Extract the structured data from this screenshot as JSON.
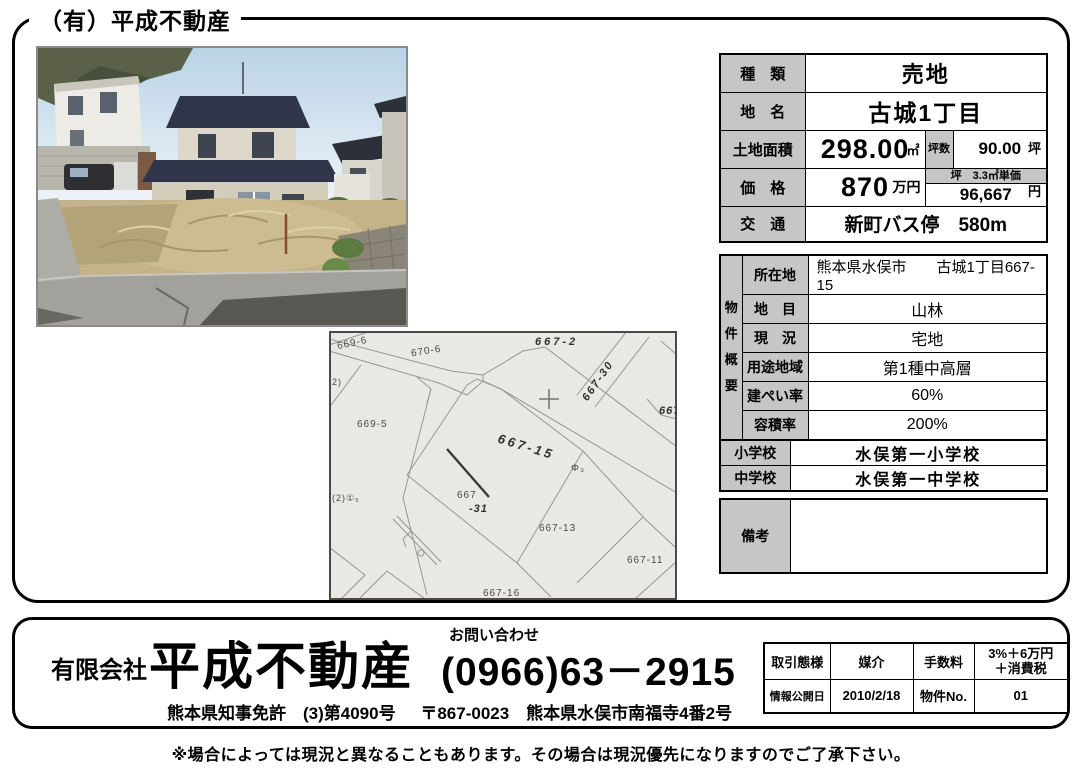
{
  "page": {
    "header_title": "（有）平成不動産",
    "disclaimer": "※場合によっては現況と異なることもあります。その場合は現況優先になりますのでご了承下さい。"
  },
  "spec": {
    "type_label": "種　類",
    "type_value": "売地",
    "name_label": "地　名",
    "name_value": "古城1丁目",
    "area_label": "土地面積",
    "area_value": "298.00",
    "area_unit": "㎡",
    "tsubo_label": "坪数",
    "tsubo_value": "90.00",
    "tsubo_unit": "坪",
    "price_label": "価　格",
    "price_value": "870",
    "price_unit": "万円",
    "unit_price_label": "坪　3.3㎡単価",
    "unit_price_value": "96,667",
    "unit_price_unit": "円",
    "access_label": "交　通",
    "access_value": "新町バス停　580m"
  },
  "overview": {
    "side_label": "物件概要",
    "rows": [
      {
        "label": "所在地",
        "value": "熊本県水俣市　　古城1丁目667-15"
      },
      {
        "label": "地　目",
        "value": "山林"
      },
      {
        "label": "現　況",
        "value": "宅地"
      },
      {
        "label": "用途地域",
        "value": "第1種中高層"
      },
      {
        "label": "建ぺい率",
        "value": "60%"
      },
      {
        "label": "容積率",
        "value": "200%"
      }
    ]
  },
  "schools": {
    "rows": [
      {
        "label": "小学校",
        "value": "水俣第一小学校"
      },
      {
        "label": "中学校",
        "value": "水俣第一中学校"
      }
    ]
  },
  "remarks": {
    "label": "備考",
    "value": ""
  },
  "map": {
    "labels": [
      {
        "text": "669-6"
      },
      {
        "text": "670-6"
      },
      {
        "text": "667-2"
      },
      {
        "text": "667-30"
      },
      {
        "text": "667"
      },
      {
        "text": "669-5"
      },
      {
        "text": "667-15"
      },
      {
        "text": "Φ₃"
      },
      {
        "text": "667"
      },
      {
        "text": "-31"
      },
      {
        "text": "667-13"
      },
      {
        "text": "667-11"
      },
      {
        "text": "667-16"
      },
      {
        "text": "2)"
      },
      {
        "text": "(2)①₅"
      }
    ]
  },
  "banner": {
    "company_prefix": "有限会社",
    "company_name": "平成不動産",
    "contact_label": "お問い合わせ",
    "phone": "(0966)63－2915",
    "license": "熊本県知事免許　(3)第4090号",
    "address": "〒867-0023　熊本県水俣市南福寺4番2号",
    "deal": {
      "r1_label1": "取引態様",
      "r1_value1": "媒介",
      "r1_label2": "手数料",
      "r1_value2": "3%＋6万円\n＋消費税",
      "r2_label1": "情報公開日",
      "r2_value1": "2010/2/18",
      "r2_label2": "物件No.",
      "r2_value2": "01"
    }
  }
}
